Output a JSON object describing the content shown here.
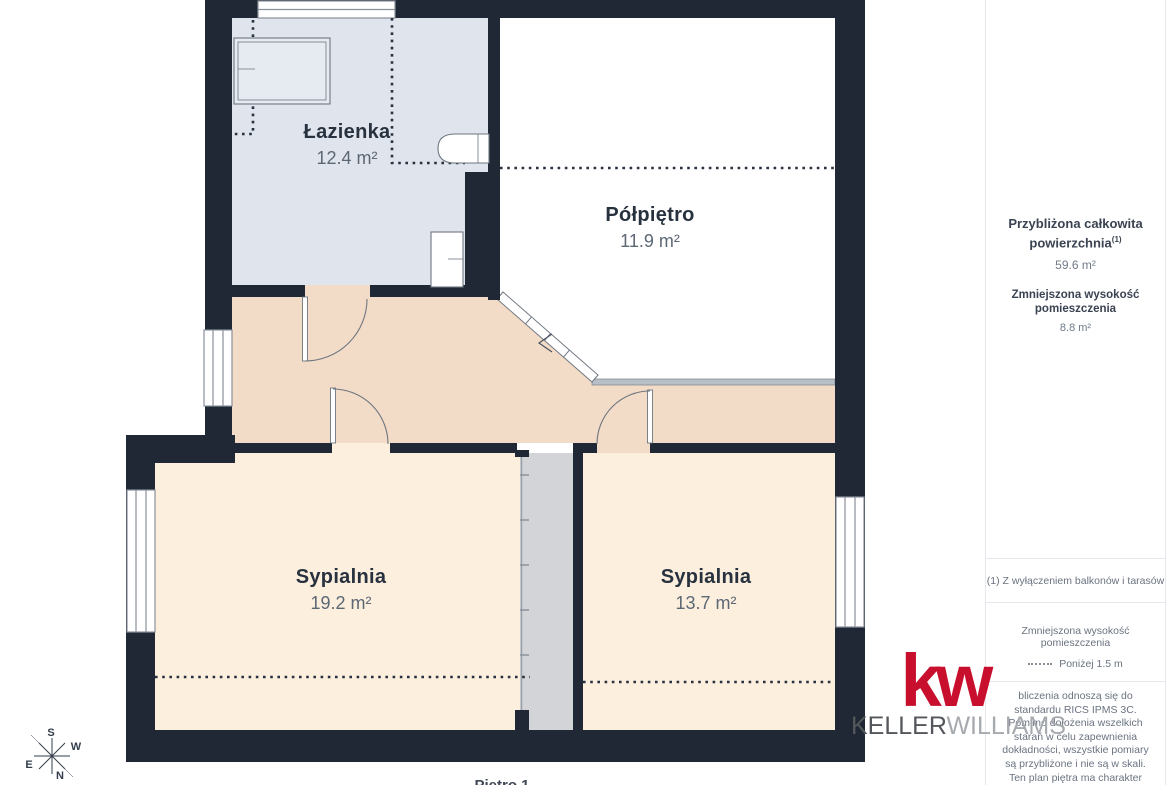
{
  "floorplan": {
    "rooms": [
      {
        "name": "Łazienka",
        "area": "12.4 m²"
      },
      {
        "name": "Półpiętro",
        "area": "11.9 m²"
      },
      {
        "name": "Sypialnia",
        "area": "19.2 m²"
      },
      {
        "name": "Sypialnia",
        "area": "13.7 m²"
      }
    ],
    "floor_label": "Piętro 1",
    "compass": {
      "n": "N",
      "s": "S",
      "e": "E",
      "w": "W"
    }
  },
  "sidebar": {
    "total_area_label_line1": "Przybliżona całkowita",
    "total_area_label_line2": "powierzchnia",
    "total_area_sup": "(1)",
    "total_area_value": "59.6 m²",
    "reduced_height_label": "Zmniejszona wysokość pomieszczenia",
    "reduced_height_value": "8.8 m²",
    "footnote": "(1) Z wyłączeniem balkonów i tarasów",
    "legend_reduced_height_label": "Zmniejszona wysokość pomieszczenia",
    "legend_reduced_height_value": "Poniżej 1.5 m",
    "disclaimer": "bliczenia odnoszą się do standardu RICS IPMS 3C. Pomimo dołożenia wszelkich starań w celu zapewnienia dokładności, wszystkie pomiary są przybliżone i nie są w skali. Ten plan piętra ma charakter poglądowy.",
    "branding_giraffe": "GIRAFFE",
    "branding_360": "360"
  },
  "logo": {
    "mark": "kw",
    "keller": "KELLER",
    "williams": "WILLIAMS"
  },
  "colors": {
    "wall": "#1f2834",
    "bathroom_floor": "#e0e5ed",
    "mezzanine_floor": "#ffffff",
    "hallway_floor": "#f3dcc7",
    "bedroom_floor": "#fcefde",
    "stair_shaft": "#d2d4d8",
    "brand_red": "#c8102e",
    "text_dark": "#28323f",
    "text_gray": "#6a7380"
  }
}
